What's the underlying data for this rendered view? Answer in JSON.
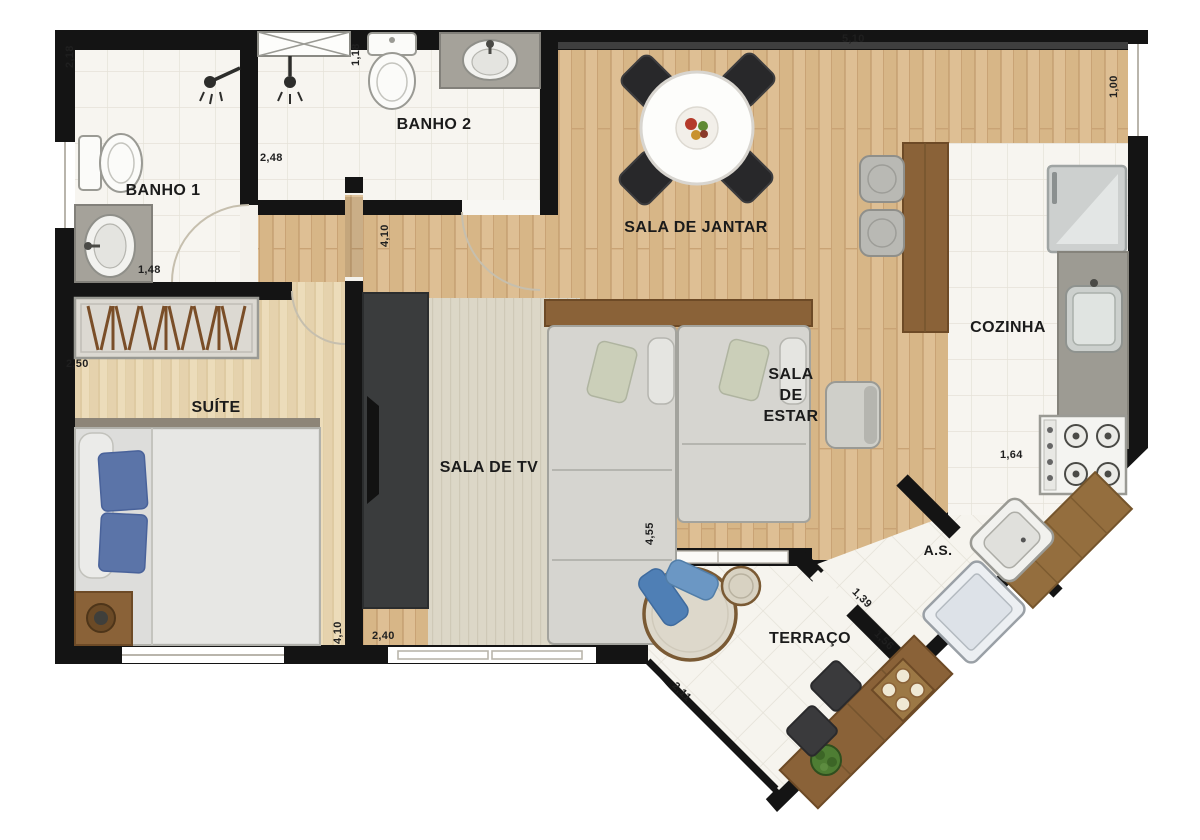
{
  "plan_title": "apartment floor plan",
  "rooms": {
    "banho1": "BANHO 1",
    "banho2": "BANHO 2",
    "sala_de_jantar": "SALA DE JANTAR",
    "cozinha": "COZINHA",
    "suite": "SUÍTE",
    "sala_de_tv": "SALA DE TV",
    "sala_de_estar": "SALA DE ESTAR",
    "area_de_servico": "A.S.",
    "terraco": "TERRAÇO"
  },
  "dimensions": {
    "d218": "2,18",
    "d118": "1,18",
    "d248": "2,48",
    "d148": "1,48",
    "d510": "5,10",
    "d100": "1,00",
    "d410_hall": "4,10",
    "d250": "2,50",
    "d164": "1,64",
    "d455": "4,55",
    "d410_suite": "4,10",
    "d240": "2,40",
    "d139": "1,39",
    "d156": "1,56",
    "d211": "2,11"
  },
  "colors": {
    "wall": "#141414",
    "wood_floor": "#debf94",
    "suite_floor": "#ecdcba",
    "tile_floor": "#f7f5f0",
    "wood_furniture": "#8a6238",
    "granite": "#9d9b93",
    "upholstery": "#d6d5d0",
    "accent_blue": "#5b74a8",
    "dark_furniture": "#2e2e30"
  }
}
